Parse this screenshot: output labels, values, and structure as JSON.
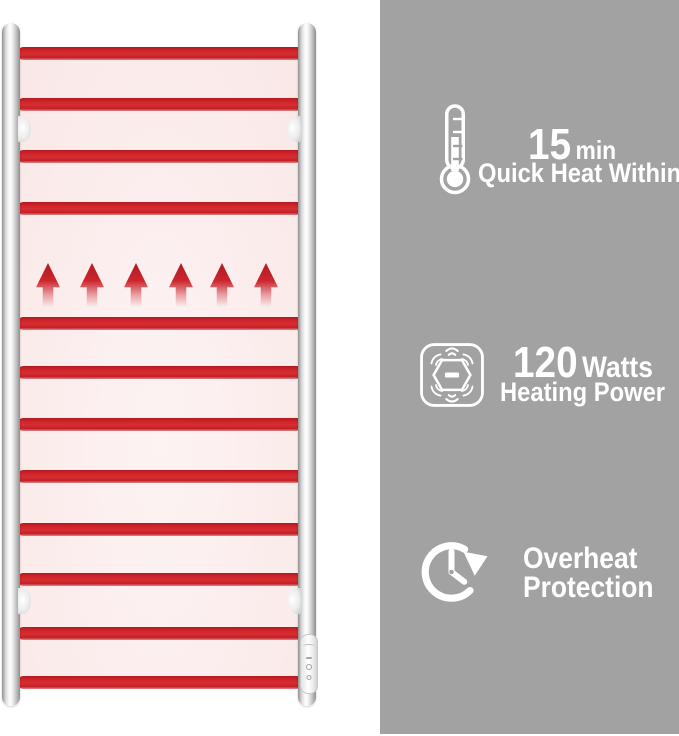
{
  "colors": {
    "panel_gray": "#a2a2a2",
    "bar_red": "#cd2127",
    "rack_pink": "#fbecec",
    "text_white": "#ffffff"
  },
  "rack": {
    "description": "heated towel rail illustration",
    "bar_count": 12,
    "bar_tops": [
      47,
      98,
      150,
      202,
      317,
      366,
      418,
      470,
      523,
      573,
      627,
      676
    ],
    "arrow_count": 6,
    "arrow_lefts": [
      36,
      80,
      124,
      169,
      210,
      254
    ],
    "bracket_tops": [
      116,
      588
    ]
  },
  "features": {
    "items": [
      {
        "name": "quick-heat",
        "icon": "thermometer-icon",
        "value": "15",
        "unit": "min",
        "label": "Quick Heat Within"
      },
      {
        "name": "heating-power",
        "icon": "heating-power-icon",
        "value": "120",
        "unit": "Watts",
        "label": "Heating Power"
      },
      {
        "name": "overheat-protection",
        "icon": "overheat-protection-icon",
        "line1": "Overheat",
        "line2": "Protection"
      }
    ]
  }
}
